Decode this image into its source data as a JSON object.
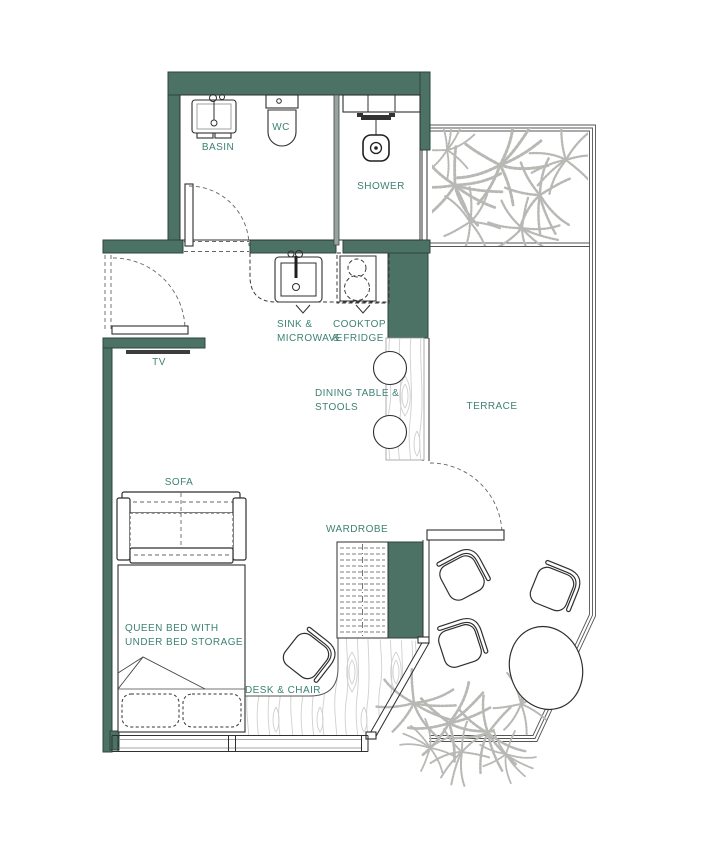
{
  "colors": {
    "wall": "#4C7266",
    "label": "#3E8273",
    "line": "#2F2F2F",
    "wood": "#CFCFCF",
    "plant": "#B8B8B4"
  },
  "labels": {
    "basin": "BASIN",
    "wc": "WC",
    "shower": "SHOWER",
    "tv": "TV",
    "sofa": "SOFA",
    "terrace": "TERRACE",
    "wardrobe": "WARDROBE",
    "desk_chair": "DESK & CHAIR",
    "sink_line1": "SINK &",
    "sink_line2": "MICROWAVE",
    "cooktop_line1": "COOKTOP",
    "cooktop_line2": "& FRIDGE",
    "dining_line1": "DINING TABLE &",
    "dining_line2": "STOOLS",
    "bed_line1": "QUEEN BED WITH",
    "bed_line2": "UNDER BED STORAGE"
  }
}
